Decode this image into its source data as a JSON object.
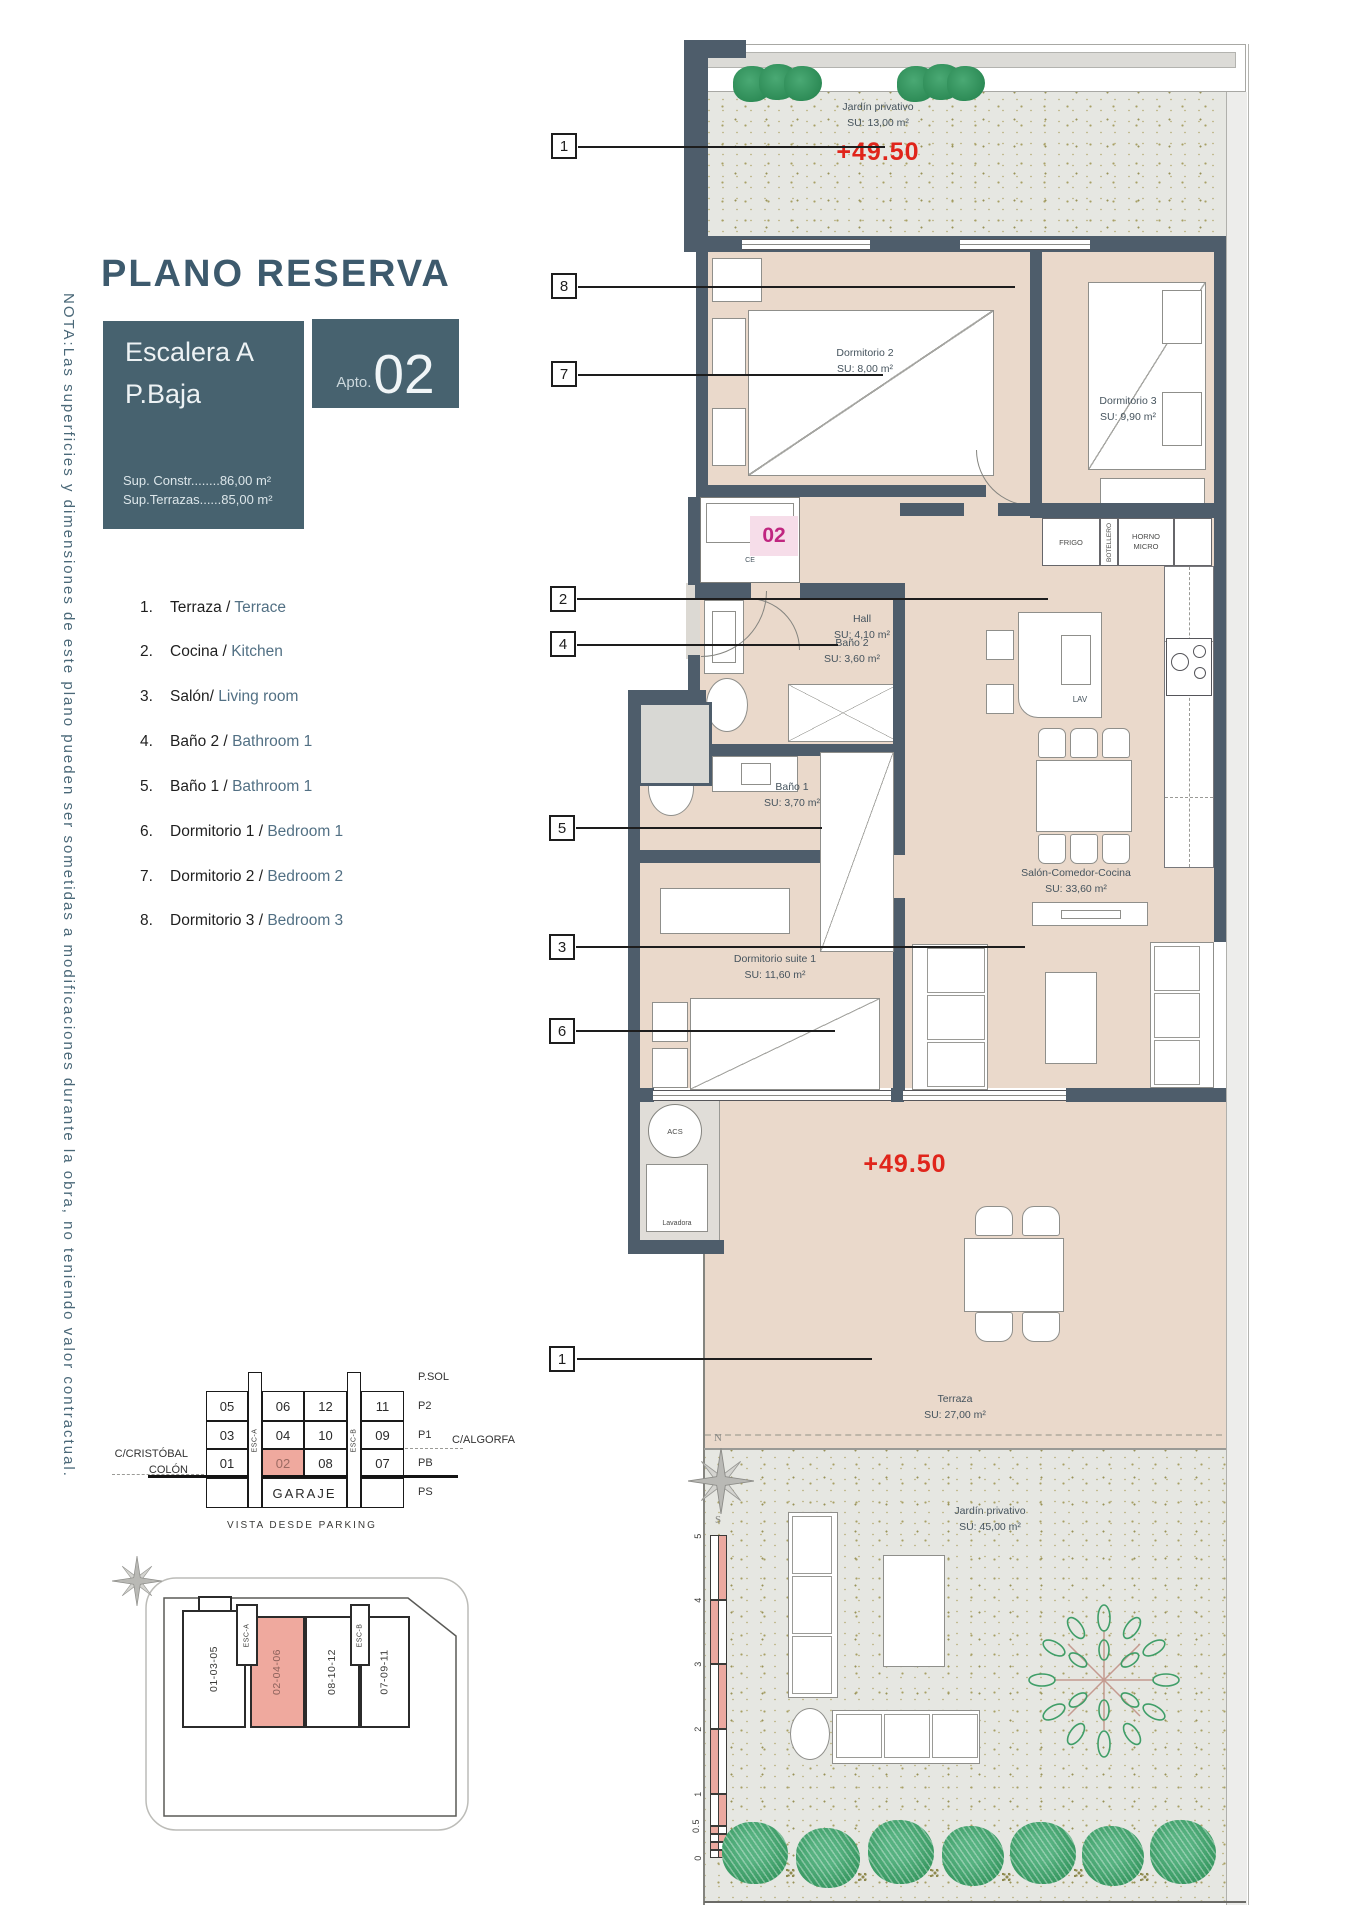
{
  "note": "NOTA:Las superficies y dimensiones de este plano pueden ser sometidas a modificaciones durante la obra, no teniendo valor contractual.",
  "title": "PLANO RESERVA",
  "header": {
    "escalera": "Escalera A",
    "planta": "P.Baja",
    "apto_prefix": "Apto.",
    "apto_number": "02",
    "sup1": "Sup. Constr........86,00 m²",
    "sup2": "Sup.Terrazas......85,00 m²"
  },
  "legend": {
    "items": [
      {
        "num": "1.",
        "es": "Terraza /",
        "en": "Terrace"
      },
      {
        "num": "2.",
        "es": "Cocina /",
        "en": "Kitchen"
      },
      {
        "num": "3.",
        "es": "Salón/",
        "en": "Living room"
      },
      {
        "num": "4.",
        "es": "Baño 2 /",
        "en": "Bathroom 1"
      },
      {
        "num": "5.",
        "es": "Baño 1 /",
        "en": "Bathroom 1"
      },
      {
        "num": "6.",
        "es": "Dormitorio 1 /",
        "en": "Bedroom 1"
      },
      {
        "num": "7.",
        "es": "Dormitorio 2 /",
        "en": "Bedroom 2"
      },
      {
        "num": "8.",
        "es": "Dormitorio 3 /",
        "en": "Bedroom 3"
      }
    ]
  },
  "callouts": {
    "top1": "1",
    "n8": "8",
    "n7": "7",
    "n2": "2",
    "n4": "4",
    "n5": "5",
    "n3": "3",
    "n6": "6",
    "bottom1": "1"
  },
  "plan": {
    "garden_top": {
      "name": "Jardín privativo",
      "area": "SU: 13,00 m²",
      "level": "+49.50"
    },
    "rooms": {
      "dorm2": {
        "name": "Dormitorio 2",
        "area": "SU: 8,00 m²"
      },
      "dorm3": {
        "name": "Dormitorio 3",
        "area": "SU: 9,90 m²"
      },
      "ce": "CE",
      "hall": {
        "name": "Hall",
        "area": "SU: 4,10 m²"
      },
      "bano2": {
        "name": "Baño 2",
        "area": "SU: 3,60 m²"
      },
      "bano1": {
        "name": "Baño 1",
        "area": "SU: 3,70 m²"
      },
      "salon": {
        "name": "Salón-Comedor-Cocina",
        "area": "SU: 33,60 m²"
      },
      "suite": {
        "name": "Dormitorio suite 1",
        "area": "SU: 11,60 m²"
      }
    },
    "kitchen": {
      "frigo": "FRIGO",
      "botellero": "BOTELLERO",
      "horno": "HORNO",
      "micro": "MICRO",
      "lav": "LAV"
    },
    "entrance_badge": "02",
    "utility": {
      "acs": "ACS",
      "lavadora": "Lavadora"
    },
    "terrace": {
      "name": "Terraza",
      "area": "SU: 27,00 m²",
      "level": "+49.50"
    },
    "garden_bottom": {
      "name": "Jardín privativo",
      "area": "SU: 45,00 m²"
    },
    "compass": {
      "n": "N",
      "s": "S"
    },
    "scale": {
      "labels": [
        "5",
        "4",
        "3",
        "2",
        "1",
        "0.5",
        "0"
      ]
    }
  },
  "building": {
    "levels": [
      "P.SOL",
      "P2",
      "P1",
      "PB",
      "PS"
    ],
    "rows": [
      {
        "cells": [
          "05",
          "06",
          "12",
          "11"
        ]
      },
      {
        "cells": [
          "03",
          "04",
          "10",
          "09"
        ]
      },
      {
        "cells": [
          "01",
          "02",
          "08",
          "07"
        ]
      }
    ],
    "esc_a": "ESC-A",
    "esc_b": "ESC-B",
    "garaje": "GARAJE",
    "street_left1": "C/CRISTÓBAL",
    "street_left2": "COLÓN",
    "street_right": "C/ALGORFA",
    "caption": "VISTA DESDE PARKING"
  },
  "site": {
    "blocks": [
      "01-03-05",
      "02-04-06",
      "08-10-12",
      "07-09-11"
    ],
    "esc_a": "ESC-A",
    "esc_b": "ESC-B"
  },
  "colors": {
    "accent": "#47626f",
    "wall": "#4e5d6b",
    "floor": "#ead9cb",
    "highlight_pink": "#efa99e",
    "level_red": "#e0251b",
    "unit_magenta": "#c02680",
    "garden_green": "#2f9158",
    "text_slate": "#527084"
  }
}
